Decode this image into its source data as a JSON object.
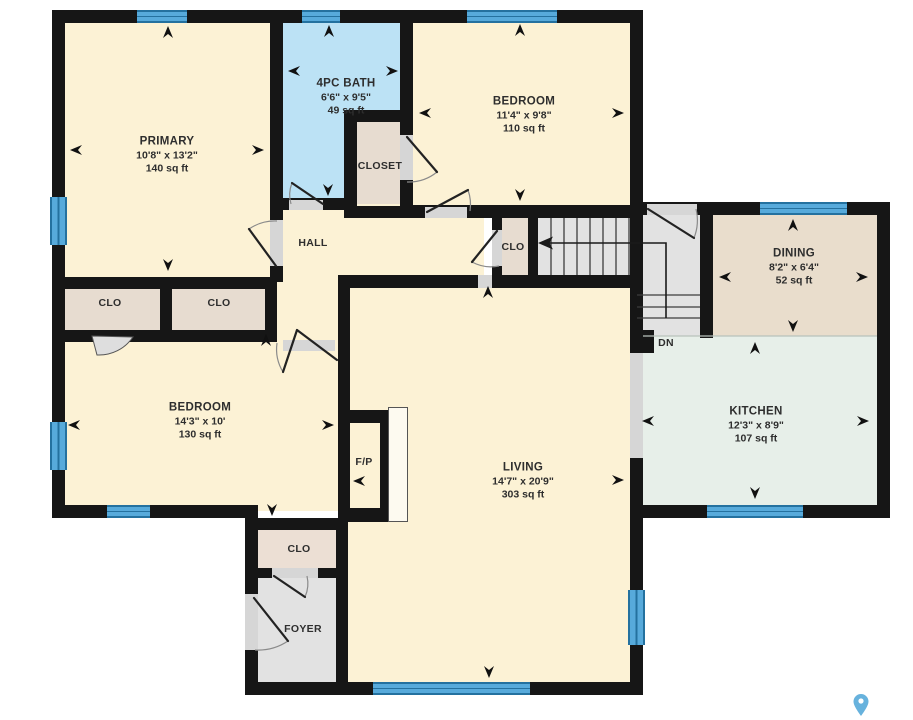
{
  "rooms": {
    "primary": {
      "name": "PRIMARY",
      "dims": "10'8\" x 13'2\"",
      "area": "140 sq ft"
    },
    "bath": {
      "name": "4PC BATH",
      "dims": "6'6\" x 9'5\"",
      "area": "49 sq ft"
    },
    "bedroom2": {
      "name": "BEDROOM",
      "dims": "11'4\" x 9'8\"",
      "area": "110 sq ft"
    },
    "dining": {
      "name": "DINING",
      "dims": "8'2\" x 6'4\"",
      "area": "52 sq ft"
    },
    "kitchen": {
      "name": "KITCHEN",
      "dims": "12'3\" x 8'9\"",
      "area": "107 sq ft"
    },
    "bedroom3": {
      "name": "BEDROOM",
      "dims": "14'3\" x 10'",
      "area": "130 sq ft"
    },
    "living": {
      "name": "LIVING",
      "dims": "14'7\" x 20'9\"",
      "area": "303 sq ft"
    }
  },
  "labels": {
    "closet": "CLOSET",
    "hall": "HALL",
    "clo": "CLO",
    "foyer": "FOYER",
    "fireplace": "F/P",
    "down": "DN"
  },
  "colors": {
    "wall": "#161616",
    "room_cream": "#fcf2d5",
    "bath_blue": "#bce2f5",
    "closet_tan": "#e7dcd0",
    "dining_tan": "#e9ddcc",
    "kitchen_mint": "#e7efe9",
    "floor_grey": "#e2e2e2",
    "window_blue": "#57aadb",
    "window_frame": "#24719f",
    "opening_grey": "#d6d6d6",
    "pin_blue": "#67b2dd"
  }
}
